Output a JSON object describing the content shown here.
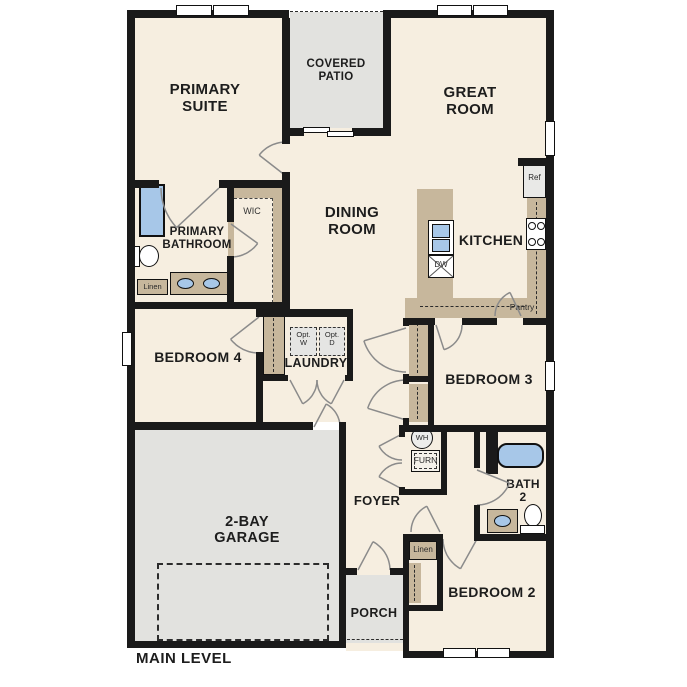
{
  "level_label": "MAIN LEVEL",
  "rooms": {
    "primary_suite": "PRIMARY SUITE",
    "covered_patio": "COVERED PATIO",
    "great_room": "GREAT ROOM",
    "dining_room": "DINING ROOM",
    "kitchen": "KITCHEN",
    "primary_bathroom": "PRIMARY BATHROOM",
    "wic": "WIC",
    "bedroom_4": "BEDROOM 4",
    "laundry": "LAUNDRY",
    "bedroom_3": "BEDROOM 3",
    "bath_2": "BATH 2",
    "garage": "2-BAY GARAGE",
    "foyer": "FOYER",
    "porch": "PORCH",
    "bedroom_2": "BEDROOM 2"
  },
  "fixtures": {
    "ref": "Ref",
    "dw": "DW",
    "pantry": "Pantry",
    "linen_bath": "Linen",
    "linen_hall": "Linen",
    "opt_w_top": "Opt.",
    "opt_w_bottom": "W",
    "opt_d_top": "Opt.",
    "opt_d_bottom": "D",
    "wh": "WH",
    "furn": "FURN"
  },
  "colors": {
    "floor": "#f6eee0",
    "outdoor": "#e2e2df",
    "counter": "#c7b79c",
    "fixture": "#a7c7e8",
    "wall": "#1a1a1a",
    "appliance": "#e9e9e7",
    "door_arc": "#8b8b8b"
  }
}
